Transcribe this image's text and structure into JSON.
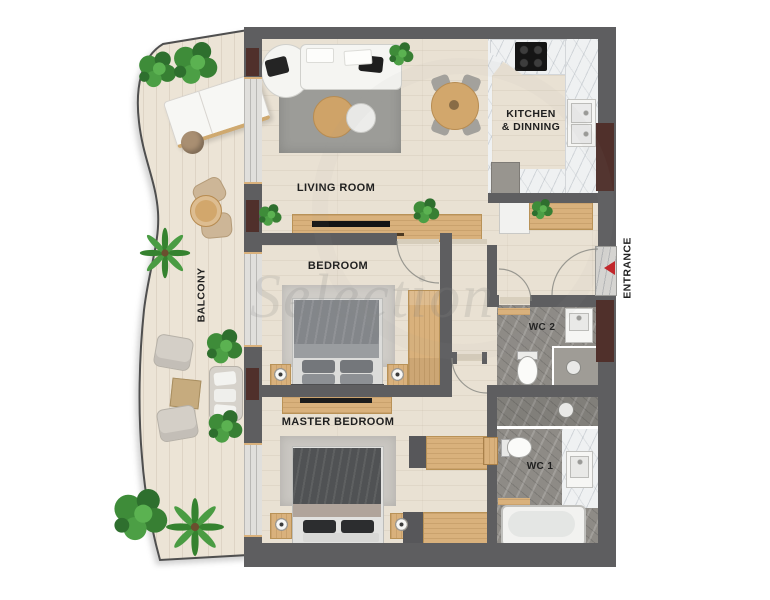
{
  "plan": {
    "watermark_text": "Selection",
    "labels": {
      "living_room": "LIVING ROOM",
      "kitchen_line1": "KITCHEN",
      "kitchen_line2": "& DINNING",
      "bedroom": "BEDROOM",
      "master_bedroom": "MASTER BEDROOM",
      "balcony": "BALCONY",
      "entrance": "ENTRANCE",
      "wc1": "WC 1",
      "wc2": "WC 2"
    },
    "colors": {
      "wall": "#5e5e60",
      "shaft": "#50302b",
      "floor": "#e9e1d3",
      "balcony-floor": "#ece4d6",
      "marble-white": "#eff1f2",
      "marble-gray": "#8e8b86",
      "wood": "#d9b17c",
      "rug-living": "#9c9c98",
      "rug-light": "#cfccc7",
      "sofa-white": "#f5f5f2",
      "plant-green": "#3f8f3a",
      "accent-red": "#c1272b",
      "text": "#1f1f1f"
    }
  }
}
